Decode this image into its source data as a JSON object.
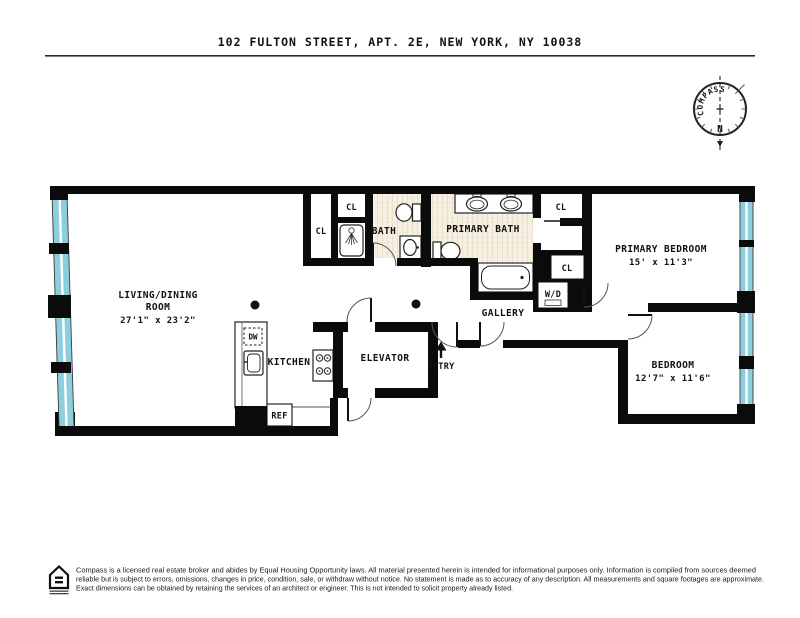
{
  "title": "102 FULTON STREET, APT. 2E, NEW YORK, NY 10038",
  "compass": {
    "label": "COMPASS",
    "north": "N"
  },
  "rooms": {
    "living": {
      "line1": "LIVING/DINING",
      "line2": "ROOM",
      "dims": "27'1\" x 23'2\""
    },
    "kitchen": {
      "label": "KITCHEN"
    },
    "elevator": {
      "label": "ELEVATOR"
    },
    "entry": {
      "label": "ENTRY"
    },
    "gallery": {
      "label": "GALLERY"
    },
    "bath": {
      "label": "BATH"
    },
    "primary_bath": {
      "label": "PRIMARY BATH"
    },
    "primary_bedroom": {
      "label": "PRIMARY BEDROOM",
      "dims": "15' x 11'3\""
    },
    "bedroom": {
      "label": "BEDROOM",
      "dims": "12'7\" x 11'6\""
    }
  },
  "labels": {
    "closet": "CL",
    "washer_dryer": "W/D",
    "refrigerator": "REF",
    "dishwasher": "DW"
  },
  "footer": {
    "line1": "Compass is a licensed real estate broker and abides by Equal Housing Opportunity laws. All material presented herein is intended for informational purposes only. Information is compiled from sources deemed",
    "line2": "reliable but is subject to errors, omissions, changes in price, condition, sale, or withdraw without notice. No statement is made as to accuracy of any description. All measurements and square footages are approximate.",
    "line3": "Exact dimensions can be obtained by retaining the services of an architect or engineer. This is not intended to solicit property already listed."
  },
  "colors": {
    "wall": "#0b0b0b",
    "window_glass": "#8ccfdc",
    "tile_floor": "#f6f1e3",
    "north_red": "#cf3a4a"
  }
}
